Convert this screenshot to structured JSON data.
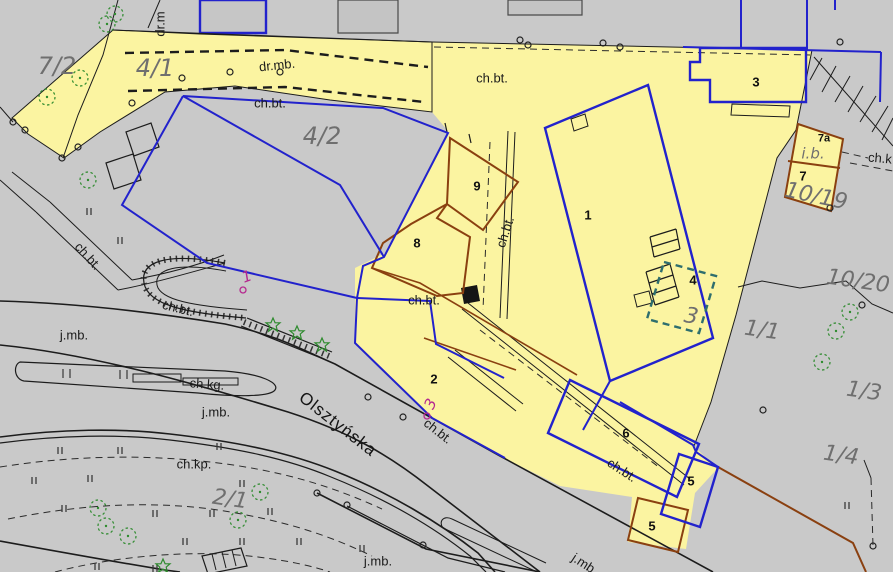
{
  "map": {
    "type": "cadastral-situational-map",
    "street_name": "Olsztyńska",
    "colors": {
      "background": "#c9c9c9",
      "highlight_yellow": "#fbf4a1",
      "parcel_blue": "#2222cc",
      "building_brown": "#8a4010",
      "planned_teal": "#2e6e6e",
      "vegetation_green": "#2e8b2e",
      "reference_magenta": "#b5298f",
      "label_gray": "#6f6f6f",
      "line_black": "#1c1c1c"
    },
    "parcel_numbers": [
      "7/2",
      "4/1",
      "4/2",
      "10/19",
      "10/20",
      "1/1",
      "1/3",
      "1/4",
      "2/1"
    ],
    "building_numbers": [
      "1",
      "2",
      "3",
      "4",
      "5",
      "5",
      "6",
      "7",
      "7a",
      "8",
      "9"
    ],
    "surface_codes": [
      "dr.mb.",
      "dr.m",
      "ch.bt.",
      "ch.kg.",
      "ch.kp.",
      "ch.k",
      "j.mb.",
      "i.b."
    ],
    "labels": [
      {
        "text": "7/2",
        "x": 57,
        "y": 66,
        "rot": 0,
        "kind": "parcel"
      },
      {
        "text": "4/1",
        "x": 155,
        "y": 68,
        "rot": 0,
        "kind": "parcel"
      },
      {
        "text": "4/2",
        "x": 322,
        "y": 136,
        "rot": 0,
        "kind": "parcel"
      },
      {
        "text": "10/19",
        "x": 816,
        "y": 197,
        "rot": 12,
        "kind": "parcel",
        "size": 22
      },
      {
        "text": "10/20",
        "x": 858,
        "y": 282,
        "rot": 8,
        "kind": "parcel",
        "size": 22
      },
      {
        "text": "1/1",
        "x": 762,
        "y": 331,
        "rot": 8,
        "kind": "parcel",
        "size": 22
      },
      {
        "text": "1/3",
        "x": 864,
        "y": 392,
        "rot": 8,
        "kind": "parcel",
        "size": 22
      },
      {
        "text": "1/4",
        "x": 841,
        "y": 456,
        "rot": 8,
        "kind": "parcel",
        "size": 22
      },
      {
        "text": "2/1",
        "x": 230,
        "y": 500,
        "rot": 8,
        "kind": "parcel",
        "size": 22
      },
      {
        "text": "3",
        "x": 691,
        "y": 317,
        "rot": 10,
        "kind": "parcel",
        "size": 22
      },
      {
        "text": "i.b.",
        "x": 813,
        "y": 154,
        "rot": 0,
        "kind": "surface-gray"
      },
      {
        "text": "1",
        "x": 588,
        "y": 215,
        "rot": 0,
        "kind": "building"
      },
      {
        "text": "2",
        "x": 434,
        "y": 379,
        "rot": 0,
        "kind": "building"
      },
      {
        "text": "3",
        "x": 756,
        "y": 82,
        "rot": 0,
        "kind": "building"
      },
      {
        "text": "4",
        "x": 693,
        "y": 280,
        "rot": 0,
        "kind": "building"
      },
      {
        "text": "5",
        "x": 691,
        "y": 481,
        "rot": 0,
        "kind": "building"
      },
      {
        "text": "5",
        "x": 652,
        "y": 526,
        "rot": 0,
        "kind": "building"
      },
      {
        "text": "6",
        "x": 626,
        "y": 433,
        "rot": 0,
        "kind": "building"
      },
      {
        "text": "7",
        "x": 803,
        "y": 176,
        "rot": 0,
        "kind": "building"
      },
      {
        "text": "7a",
        "x": 824,
        "y": 139,
        "rot": 0,
        "kind": "building",
        "size": 11
      },
      {
        "text": "8",
        "x": 417,
        "y": 243,
        "rot": 0,
        "kind": "building"
      },
      {
        "text": "9",
        "x": 477,
        "y": 186,
        "rot": 0,
        "kind": "building"
      },
      {
        "text": "dr.mb.",
        "x": 277,
        "y": 65,
        "rot": -6,
        "kind": "surface"
      },
      {
        "text": "dr.m",
        "x": 160,
        "y": 24,
        "rot": -90,
        "kind": "surface"
      },
      {
        "text": "ch.bt.",
        "x": 270,
        "y": 103,
        "rot": 0,
        "kind": "surface"
      },
      {
        "text": "ch.bt.",
        "x": 492,
        "y": 78,
        "rot": 0,
        "kind": "surface"
      },
      {
        "text": "ch.bt.",
        "x": 505,
        "y": 232,
        "rot": -72,
        "kind": "surface"
      },
      {
        "text": "ch.bt.",
        "x": 424,
        "y": 300,
        "rot": 0,
        "kind": "surface"
      },
      {
        "text": "ch.bt.",
        "x": 88,
        "y": 256,
        "rot": 48,
        "kind": "surface"
      },
      {
        "text": "ch.bt.",
        "x": 178,
        "y": 308,
        "rot": 14,
        "kind": "surface"
      },
      {
        "text": "ch.bt.",
        "x": 438,
        "y": 431,
        "rot": 38,
        "kind": "surface"
      },
      {
        "text": "ch.bt.",
        "x": 622,
        "y": 470,
        "rot": 33,
        "kind": "surface"
      },
      {
        "text": "ch.kg.",
        "x": 207,
        "y": 384,
        "rot": 4,
        "kind": "surface"
      },
      {
        "text": "ch.kp.",
        "x": 194,
        "y": 464,
        "rot": 0,
        "kind": "surface"
      },
      {
        "text": "ch.k",
        "x": 880,
        "y": 158,
        "rot": 5,
        "kind": "surface"
      },
      {
        "text": "j.mb.",
        "x": 74,
        "y": 335,
        "rot": 0,
        "kind": "surface"
      },
      {
        "text": "j.mb.",
        "x": 216,
        "y": 412,
        "rot": 0,
        "kind": "surface"
      },
      {
        "text": "j.mb.",
        "x": 378,
        "y": 561,
        "rot": 0,
        "kind": "surface"
      },
      {
        "text": "j.mb.",
        "x": 585,
        "y": 564,
        "rot": 33,
        "kind": "surface"
      },
      {
        "text": "Olsztyńska",
        "x": 338,
        "y": 424,
        "rot": 38,
        "kind": "street"
      },
      {
        "text": "1",
        "x": 247,
        "y": 277,
        "rot": -20,
        "kind": "ref"
      },
      {
        "text": "3",
        "x": 431,
        "y": 404,
        "rot": -65,
        "kind": "ref"
      }
    ]
  }
}
